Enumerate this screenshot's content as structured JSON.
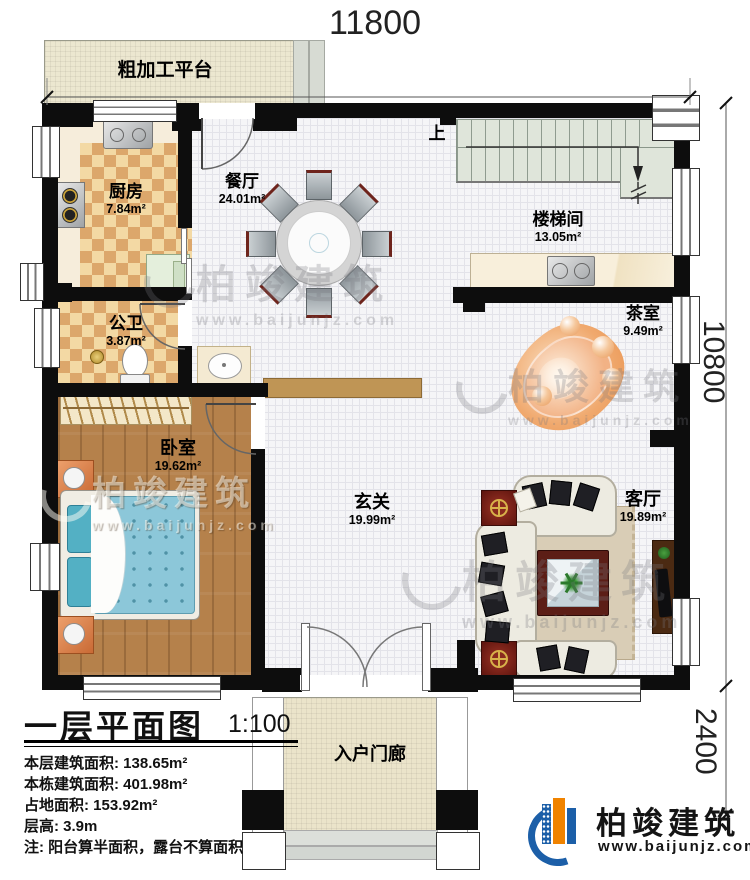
{
  "dimensions": {
    "top": "11800",
    "right_upper": "10800",
    "right_lower": "2400"
  },
  "stairs": {
    "up_label": "上"
  },
  "rooms": {
    "platform": {
      "name": "粗加工平台"
    },
    "kitchen": {
      "name": "厨房",
      "area": "7.84m²"
    },
    "dining": {
      "name": "餐厅",
      "area": "24.01m²"
    },
    "stairwell": {
      "name": "楼梯间",
      "area": "13.05m²"
    },
    "tearoom": {
      "name": "茶室",
      "area": "9.49m²"
    },
    "bathroom": {
      "name": "公卫",
      "area": "3.87m²"
    },
    "bedroom": {
      "name": "卧室",
      "area": "19.62m²"
    },
    "hall": {
      "name": "玄关",
      "area": "19.99m²"
    },
    "living": {
      "name": "客厅",
      "area": "19.89m²"
    },
    "porch": {
      "name": "入户门廊"
    }
  },
  "title_block": {
    "title": "一层平面图",
    "scale": "1:100",
    "stats": [
      "本层建筑面积: 138.65m²",
      "本栋建筑面积: 401.98m²",
      "占地面积: 153.92m²",
      "层高: 3.9m",
      "注: 阳台算半面积，露台不算面积"
    ]
  },
  "brand": {
    "name": "柏竣建筑",
    "url": "www.baijunjz.com"
  },
  "watermark": {
    "name": "柏竣建筑",
    "url": "www.baijunjz.com"
  },
  "colors": {
    "wall": "#0d0d0d",
    "wood_floor": "#b5814b",
    "checker_tan": "#dca76b",
    "stair_green": "#dfe5da",
    "brand_blue": "#1c5fa8",
    "brand_orange": "#f08300",
    "tea_orange": "#eda165",
    "watermark_gray": "#8a8a8f"
  }
}
